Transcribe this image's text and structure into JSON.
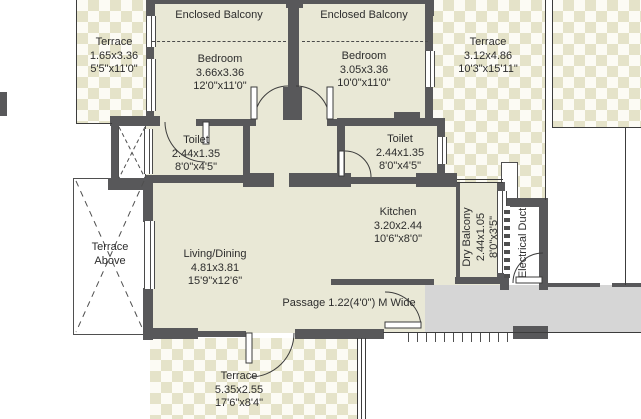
{
  "colors": {
    "wall": "#58585a",
    "room_fill": "#e9e8d6",
    "terrace_check": "#e5e3c9",
    "corridor_gray": "#d6d6d6",
    "line": "#3c3c3c"
  },
  "rooms": {
    "enclosed_balcony_left": {
      "name": "Enclosed Balcony"
    },
    "enclosed_balcony_right": {
      "name": "Enclosed Balcony"
    },
    "terrace_left": {
      "name": "Terrace",
      "metric": "1.65x3.36",
      "imperial": "5'5\"x11'0\""
    },
    "bedroom_left": {
      "name": "Bedroom",
      "metric": "3.66x3.36",
      "imperial": "12'0\"x11'0\""
    },
    "bedroom_right": {
      "name": "Bedroom",
      "metric": "3.05x3.36",
      "imperial": "10'0\"x11'0\""
    },
    "terrace_right": {
      "name": "Terrace",
      "metric": "3.12x4.86",
      "imperial": "10'3\"x15'11\""
    },
    "toilet_left": {
      "name": "Toilet",
      "metric": "2.44x1.35",
      "imperial": "8'0\"x4'5\""
    },
    "toilet_right": {
      "name": "Toilet",
      "metric": "2.44x1.35",
      "imperial": "8'0\"x4'5\""
    },
    "terrace_above": {
      "line1": "Terrace",
      "line2": "Above"
    },
    "living_dining": {
      "name": "Living/Dining",
      "metric": "4.81x3.81",
      "imperial": "15'9\"x12'6\""
    },
    "kitchen": {
      "name": "Kitchen",
      "metric": "3.20x2.44",
      "imperial": "10'6\"x8'0\""
    },
    "dry_balcony": {
      "name": "Dry Balcony",
      "metric": "2.44x1.05",
      "imperial": "8'0\"x3'5\""
    },
    "electrical_duct": {
      "name": "Electrical Duct"
    },
    "terrace_bottom": {
      "name": "Terrace",
      "metric": "5.35x2.55",
      "imperial": "17'6\"x8'4\""
    }
  },
  "passage_label": "Passage 1.22(4'0\") M Wide"
}
